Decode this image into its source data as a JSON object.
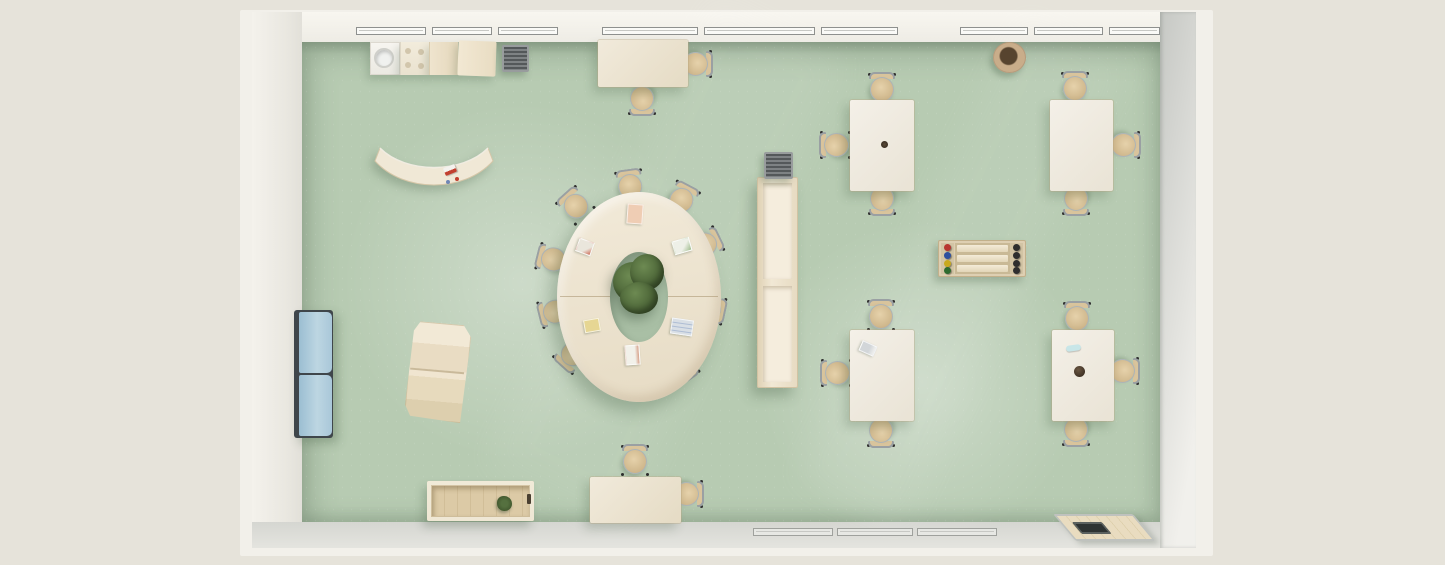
{
  "scene": {
    "name": "classroom-top-down-render",
    "description_tags": [
      "top-view-floor-plan",
      "classroom",
      "furniture-layout"
    ],
    "room": {
      "floor": "sage-green",
      "walls": "white",
      "window_rows": [
        {
          "name": "window-row-top",
          "segments": 9
        },
        {
          "name": "window-row-bottom",
          "segments": 3
        }
      ]
    },
    "furniture": [
      {
        "name": "kitchen-unit",
        "parts": [
          "sink-cabinet",
          "stove-top",
          "cabinet",
          "cabinet",
          "drying-rack"
        ]
      },
      {
        "name": "rect-table-top-wall",
        "chairs": 2
      },
      {
        "name": "round-stool"
      },
      {
        "name": "rect-table-ne-left",
        "chairs": 3
      },
      {
        "name": "rect-table-ne-right",
        "chairs": 3
      },
      {
        "name": "curved-table",
        "items": [
          "pencil-box",
          "red-item",
          "blue-item"
        ]
      },
      {
        "name": "oval-ring-table",
        "chairs": 10,
        "items": [
          "potted-plant",
          "paper-cards"
        ]
      },
      {
        "name": "tall-shelf",
        "items": [
          "gray-basket"
        ]
      },
      {
        "name": "foosball-table",
        "knob_columns": 2
      },
      {
        "name": "blue-cabinet",
        "doors": 2
      },
      {
        "name": "step-shelf"
      },
      {
        "name": "rect-table-se-left",
        "chairs": 3,
        "items": [
          "notebook"
        ]
      },
      {
        "name": "rect-table-se-right",
        "chairs": 3,
        "items": [
          "pencil-case",
          "plant-pot"
        ]
      },
      {
        "name": "storage-bench",
        "items": [
          "small-plant"
        ]
      },
      {
        "name": "rect-table-bottom-wall",
        "chairs": 2
      },
      {
        "name": "floor-mat",
        "items": [
          "dark-slot"
        ]
      }
    ]
  },
  "colors": {
    "bg": "#e6e3da",
    "slab": "#f2f0ea",
    "floor": "#b7cbb2",
    "floor_shade": "#a9bfa5",
    "window_frame": "#8e908e",
    "wood": "#ece3d0",
    "white_table": "#f1ede4",
    "seat": "#d9c49c",
    "metal": "#9aa0a3",
    "feet": "#2e2e2e",
    "blue_cabinet": "#a9c7d9",
    "plant": "#4e6a3a",
    "vent": "#75797a",
    "basket": "#5f6263",
    "stool_rim": "#cfb392",
    "stool_center": "#57442f",
    "knob_red": "#b8352f",
    "knob_blue": "#2d4f9e",
    "knob_yellow": "#c8a91f",
    "knob_green": "#2e6b2f",
    "knob_dark": "#2e2e2e",
    "paper_pink": "#efcdb4",
    "paper_yellow": "#e6d693",
    "paper_blue": "#d9dfe5",
    "paper_white": "#f2f1ea",
    "pencil_red": "#c2402f",
    "case_blue": "#c8e6e8",
    "slot_dark": "#2e3332"
  }
}
